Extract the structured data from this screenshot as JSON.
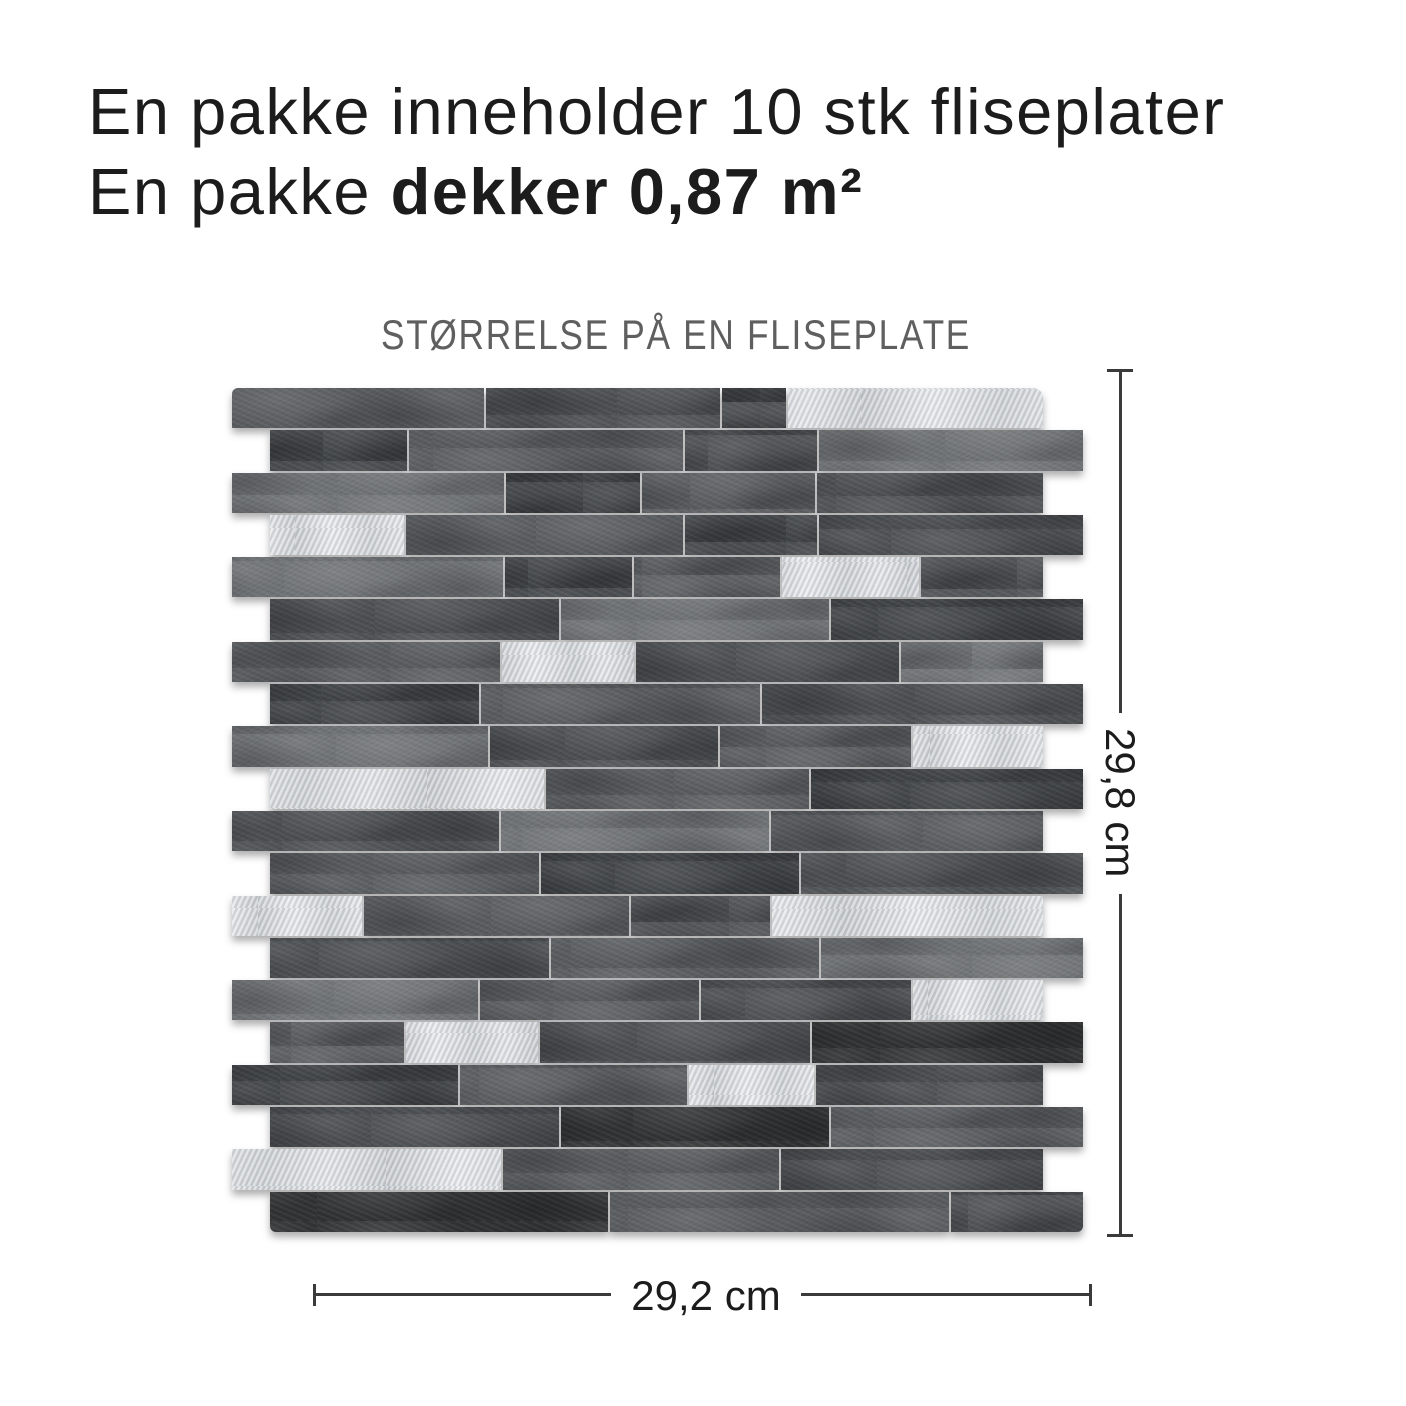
{
  "heading": {
    "line1": "En pakke inneholder 10 stk fliseplater",
    "line2_regular": "En pakke ",
    "line2_bold": "dekker 0,87 m²"
  },
  "caption": "STØRRELSE PÅ EN FLISEPLATE",
  "dimensions": {
    "height_label": "29,8 cm",
    "width_label": "29,2 cm"
  },
  "colors": {
    "background": "#ffffff",
    "text": "#1c1c1c",
    "caption": "#5f5f5f",
    "dimension_line": "#3a3a3a",
    "metal": "#d6d9dc",
    "brick_shades": {
      "g2": "#6f7275",
      "g3": "#585b5e",
      "g4": "#4b4e51",
      "g5": "#404346",
      "g6": "#2f3133"
    }
  },
  "panel": {
    "description": "peel-and-stick stone-look mosaic tile sheet, dark grey slate strips with brushed aluminium accent strips, staggered brick bond",
    "rows": [
      {
        "shifted": false,
        "bricks": [
          [
            "g3",
            254
          ],
          [
            "g4",
            236
          ],
          [
            "g5",
            64
          ],
          [
            "silver",
            257
          ]
        ]
      },
      {
        "shifted": true,
        "bricks": [
          [
            "g5",
            138
          ],
          [
            "g3",
            276
          ],
          [
            "g4",
            133
          ],
          [
            "g2",
            266
          ]
        ]
      },
      {
        "shifted": false,
        "bricks": [
          [
            "g2",
            274
          ],
          [
            "g5",
            135
          ],
          [
            "g3",
            174
          ],
          [
            "g4",
            228
          ]
        ]
      },
      {
        "shifted": true,
        "bricks": [
          [
            "silver",
            135
          ],
          [
            "g3",
            279
          ],
          [
            "g5",
            133
          ],
          [
            "g4",
            266
          ]
        ]
      },
      {
        "shifted": false,
        "bricks": [
          [
            "g2",
            274
          ],
          [
            "g5",
            128
          ],
          [
            "g3",
            147
          ],
          [
            "silver",
            139
          ],
          [
            "g4",
            123
          ]
        ]
      },
      {
        "shifted": true,
        "bricks": [
          [
            "g4",
            290
          ],
          [
            "g2",
            270
          ],
          [
            "g5",
            253
          ]
        ]
      },
      {
        "shifted": false,
        "bricks": [
          [
            "g3",
            270
          ],
          [
            "silver",
            133
          ],
          [
            "g4",
            265
          ],
          [
            "g2",
            143
          ]
        ]
      },
      {
        "shifted": true,
        "bricks": [
          [
            "g5",
            210
          ],
          [
            "g3",
            280
          ],
          [
            "g4",
            323
          ]
        ]
      },
      {
        "shifted": false,
        "bricks": [
          [
            "g2",
            258
          ],
          [
            "g4",
            230
          ],
          [
            "g3",
            192
          ],
          [
            "silver",
            131
          ]
        ]
      },
      {
        "shifted": true,
        "bricks": [
          [
            "silver",
            275
          ],
          [
            "g3",
            265
          ],
          [
            "g5",
            273
          ]
        ]
      },
      {
        "shifted": false,
        "bricks": [
          [
            "g4",
            268
          ],
          [
            "g2",
            270
          ],
          [
            "g3",
            273
          ]
        ]
      },
      {
        "shifted": true,
        "bricks": [
          [
            "g3",
            270
          ],
          [
            "g5",
            260
          ],
          [
            "g4",
            283
          ]
        ]
      },
      {
        "shifted": false,
        "bricks": [
          [
            "silver",
            131
          ],
          [
            "g3",
            267
          ],
          [
            "g4",
            140
          ],
          [
            "silver",
            273
          ]
        ]
      },
      {
        "shifted": true,
        "bricks": [
          [
            "g4",
            280
          ],
          [
            "g3",
            270
          ],
          [
            "g2",
            263
          ]
        ]
      },
      {
        "shifted": false,
        "bricks": [
          [
            "g2",
            248
          ],
          [
            "g3",
            220
          ],
          [
            "g4",
            212
          ],
          [
            "silver",
            131
          ]
        ]
      },
      {
        "shifted": true,
        "bricks": [
          [
            "g3",
            135
          ],
          [
            "silver",
            133
          ],
          [
            "g4",
            272
          ],
          [
            "g6",
            273
          ]
        ]
      },
      {
        "shifted": false,
        "bricks": [
          [
            "g5",
            228
          ],
          [
            "g3",
            228
          ],
          [
            "silver",
            126
          ],
          [
            "g4",
            229
          ]
        ]
      },
      {
        "shifted": true,
        "bricks": [
          [
            "g4",
            290
          ],
          [
            "g6",
            270
          ],
          [
            "g3",
            253
          ]
        ]
      },
      {
        "shifted": false,
        "bricks": [
          [
            "silver",
            270
          ],
          [
            "g3",
            278
          ],
          [
            "g4",
            263
          ]
        ]
      },
      {
        "shifted": true,
        "bricks": [
          [
            "g6",
            340
          ],
          [
            "g3",
            340
          ],
          [
            "g4",
            133
          ]
        ]
      }
    ]
  }
}
